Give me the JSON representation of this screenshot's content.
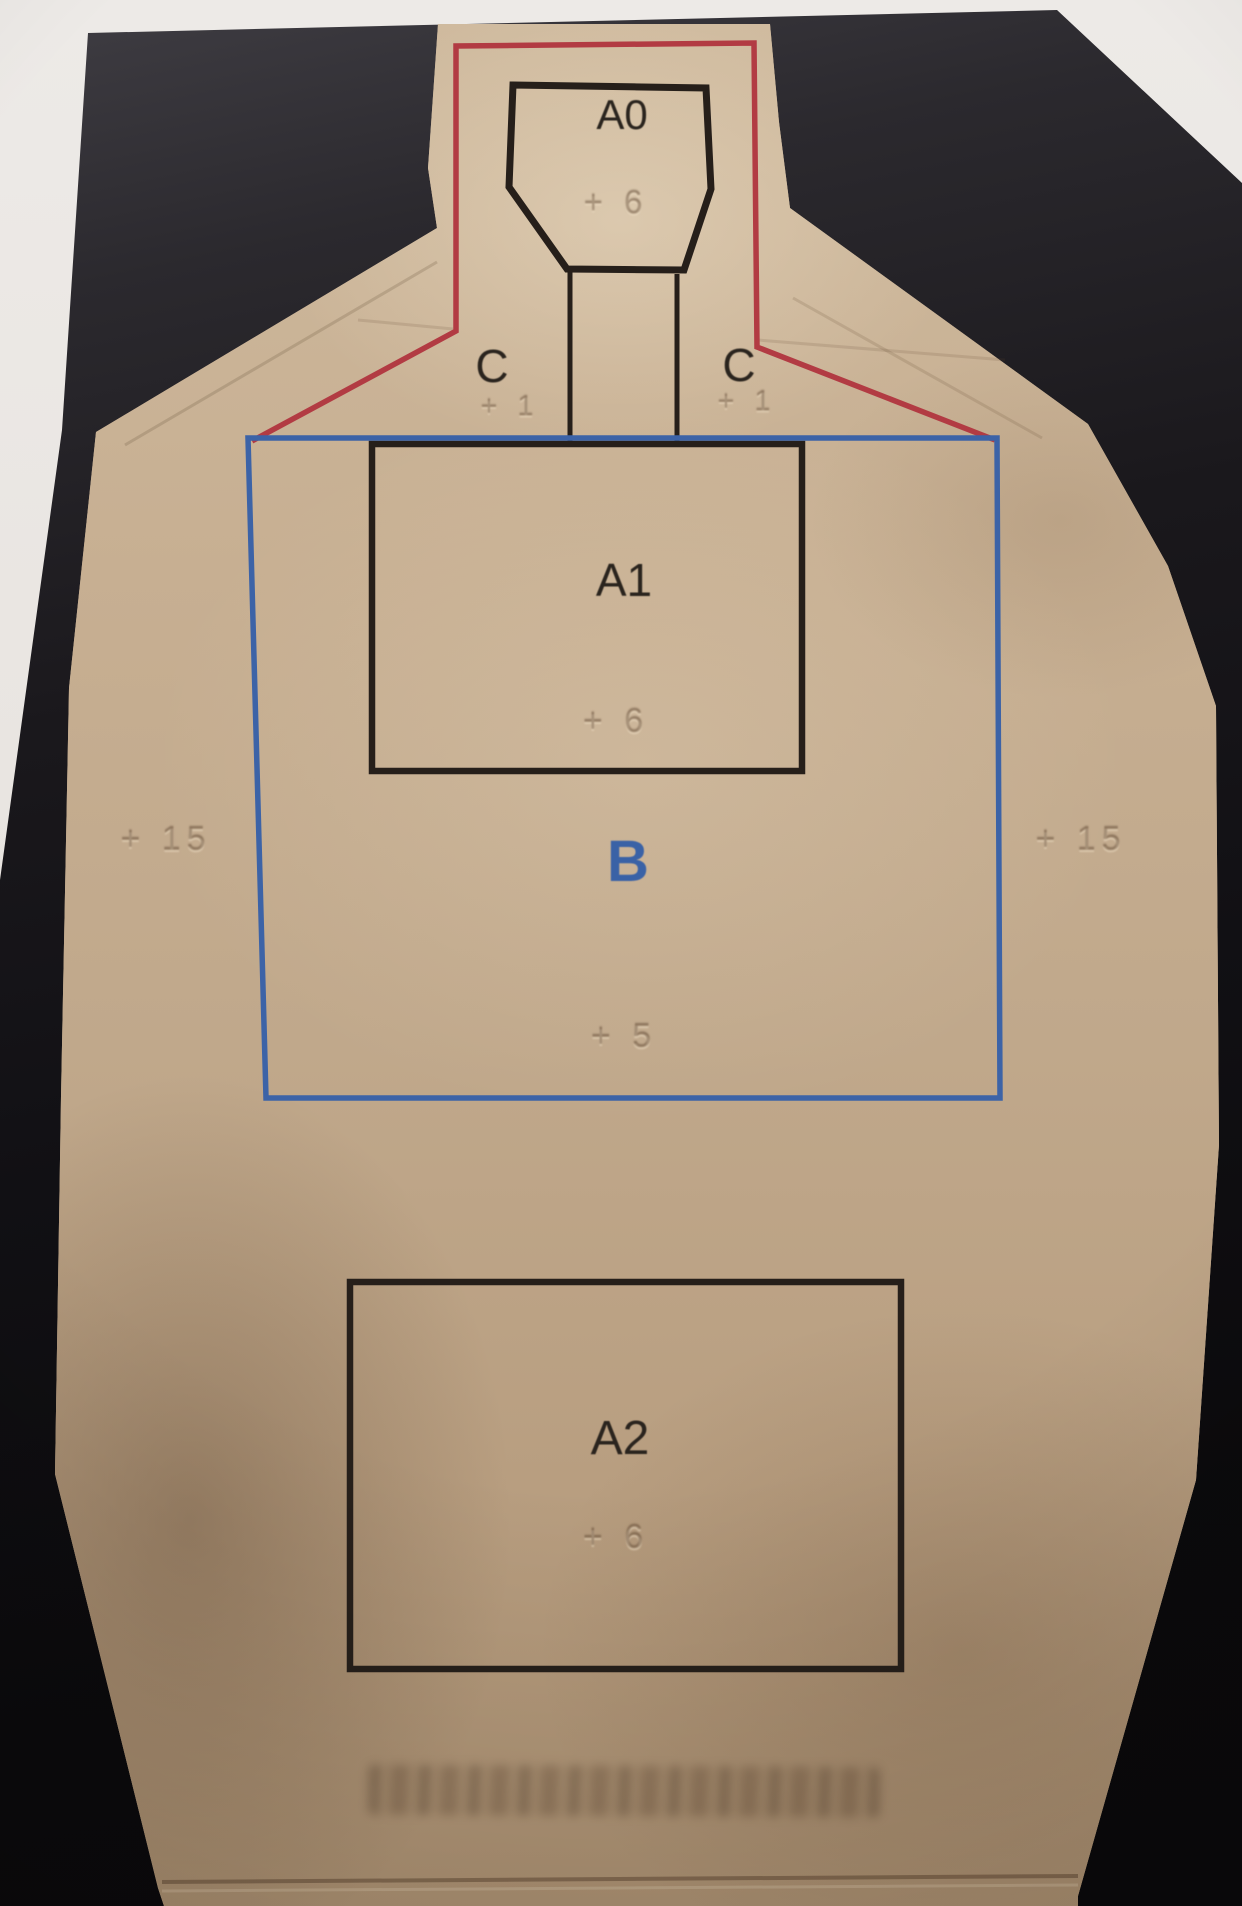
{
  "description": "Photograph of a tan cardboard silhouette shooting target lying on a black backdrop over white paper",
  "target": {
    "head": {
      "label": "A0",
      "score": "+ 6"
    },
    "neck_left": {
      "label": "C",
      "score": "+ 1"
    },
    "neck_right": {
      "label": "C",
      "score": "+ 1"
    },
    "chest": {
      "label": "A1",
      "score": "+ 6"
    },
    "body": {
      "label": "B",
      "score": "+ 5"
    },
    "edge_left": {
      "score": "+ 15"
    },
    "edge_right": {
      "score": "+ 15"
    },
    "pelvis": {
      "label": "A2",
      "score": "+ 6"
    }
  },
  "colors": {
    "paper_background": "#e9e5e1",
    "backdrop_black": "#121014",
    "cardboard_tan": "#c0a88b",
    "head_outline_red": "#b23b43",
    "body_outline_blue": "#3c63a7",
    "zone_outline_black": "#261f1a",
    "body_label_blue": "#3a62a6"
  }
}
